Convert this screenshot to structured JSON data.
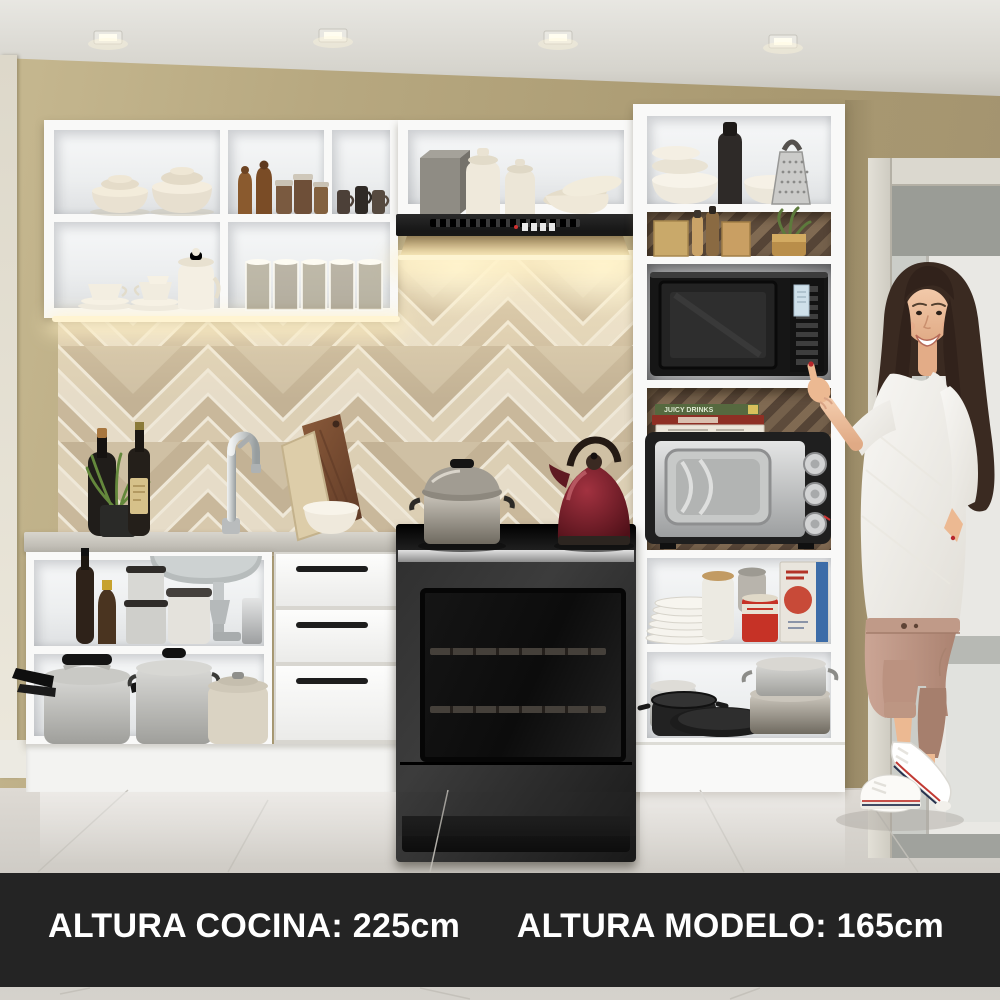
{
  "banner": {
    "kitchen_height_label": "ALTURA COCINA: 225cm",
    "model_height_label": "ALTURA MODELO: 165cm",
    "background_color": "#242424",
    "text_color": "#ffffff"
  },
  "scene": {
    "book_spine_label": "JUICY DRINKS",
    "colors": {
      "wall_tan": "#b3a47c",
      "ceiling": "#dfdeD8",
      "cabinet_white": "#f9f9f8",
      "backsplash_tile_base": "#cfc0a4",
      "countertop_gray": "#c6c3bb",
      "appliance_black": "#1a1a1a",
      "toaster_oven_steel": "#c6c7c8",
      "kettle_burgundy": "#6e1f29",
      "under_cabinet_glow": "#ffe9b8",
      "floor_tile": "#d6d2cc",
      "pants_tan": "#c09a88",
      "sweater_white": "#f4f3f0",
      "hair_brown": "#3a2a21",
      "sneaker_white": "#ffffff"
    }
  }
}
